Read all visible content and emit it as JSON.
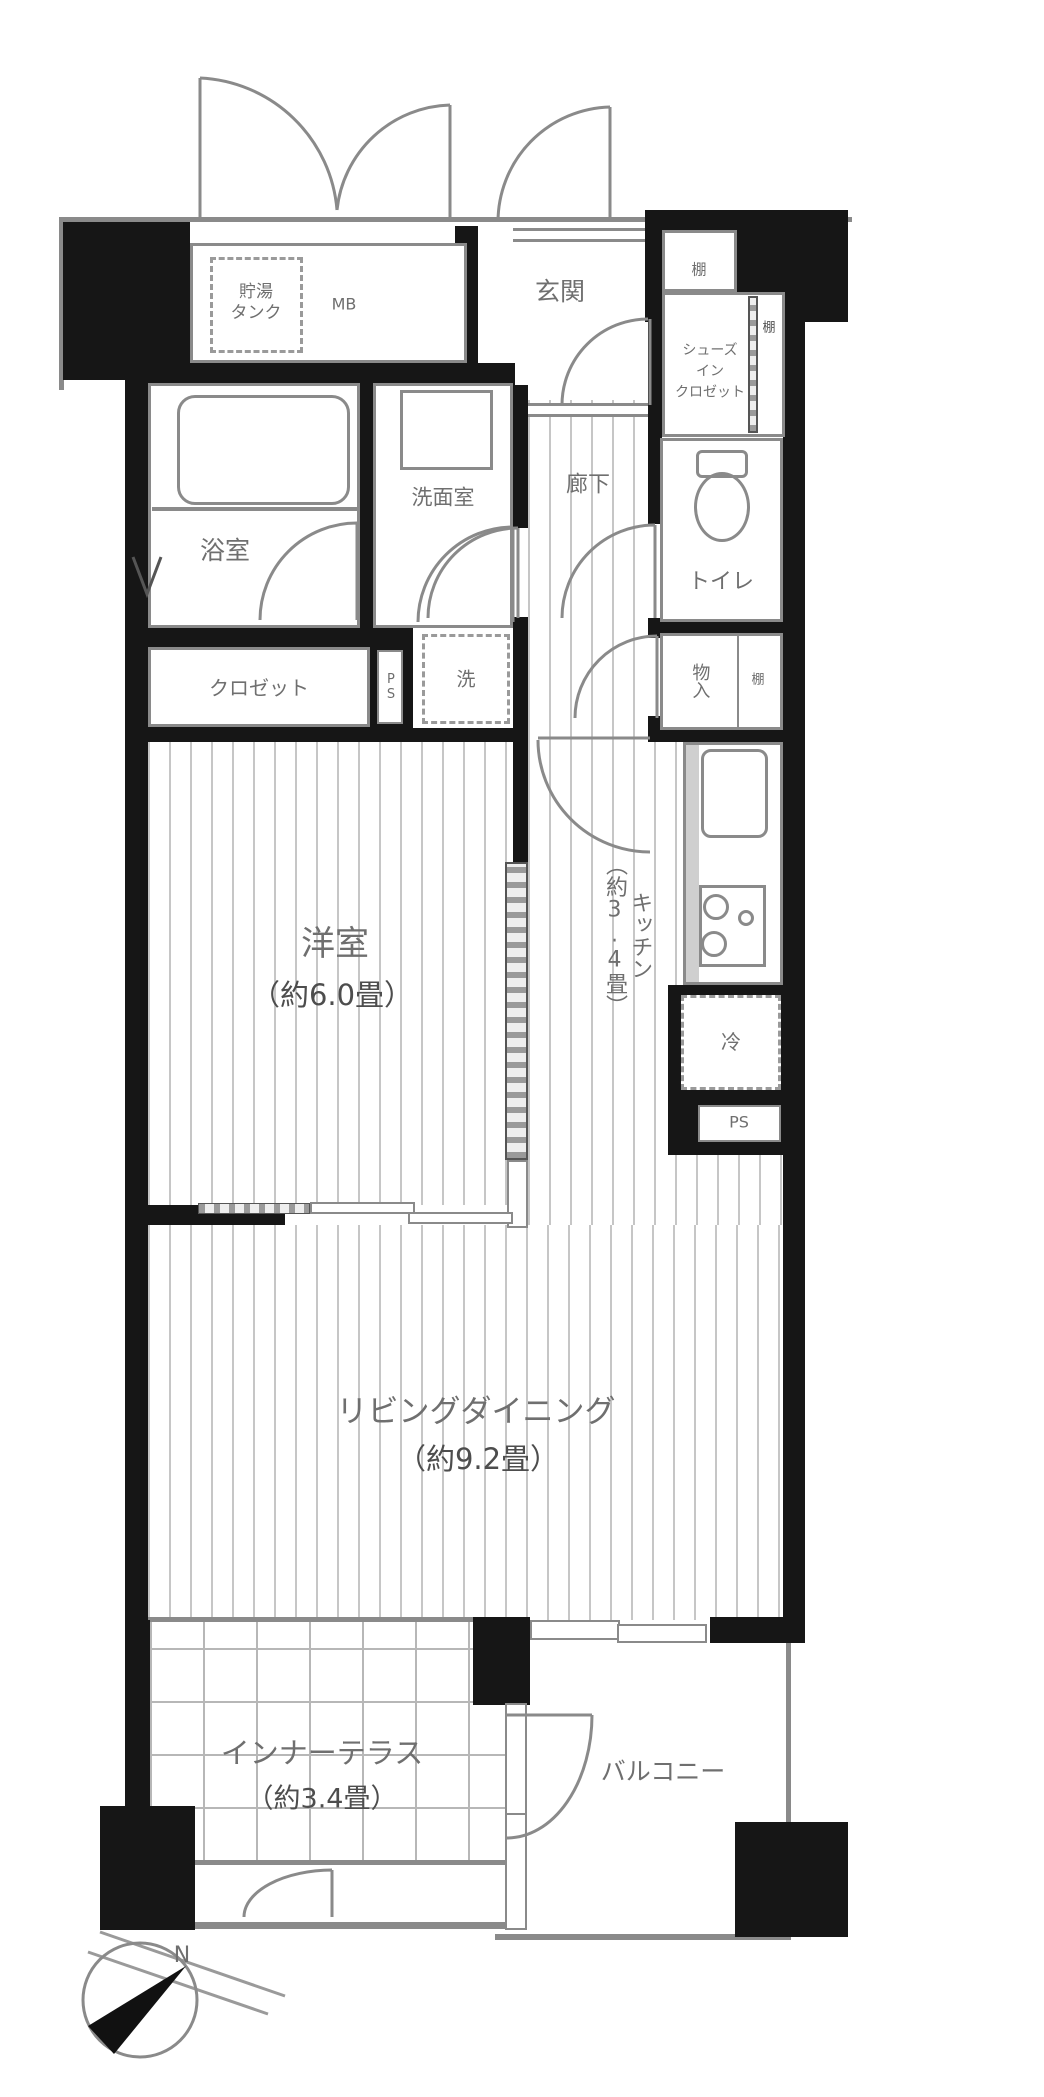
{
  "plan": {
    "compass_label": "N",
    "rooms": {
      "entrance": {
        "name": "玄関"
      },
      "hallway": {
        "name": "廊下"
      },
      "bathroom": {
        "name": "浴室"
      },
      "washroom": {
        "name": "洗面室"
      },
      "toilet": {
        "name": "トイレ"
      },
      "closet": {
        "name": "クロゼット"
      },
      "shoes_closet": {
        "line1": "シューズ",
        "line2": "イン",
        "line3": "クロゼット"
      },
      "storage": {
        "name": "物入"
      },
      "western_room": {
        "name": "洋室",
        "size": "（約6.0畳）"
      },
      "kitchen": {
        "name": "キッチン\n（約3.4畳）"
      },
      "living_dining": {
        "name": "リビングダイニング",
        "size": "（約9.2畳）"
      },
      "inner_terrace": {
        "name": "インナーテラス",
        "size": "（約3.4畳）"
      },
      "balcony": {
        "name": "バルコニー"
      }
    },
    "equipment": {
      "water_tank": {
        "line1": "貯湯",
        "line2": "タンク"
      },
      "meter_box": "MB",
      "shelf": "棚",
      "laundry": "洗",
      "fridge": "冷",
      "pipe_space": "PS"
    },
    "colors": {
      "wall": "#161616",
      "line": "#8a8a8a",
      "text": "#6f6f6f"
    }
  }
}
